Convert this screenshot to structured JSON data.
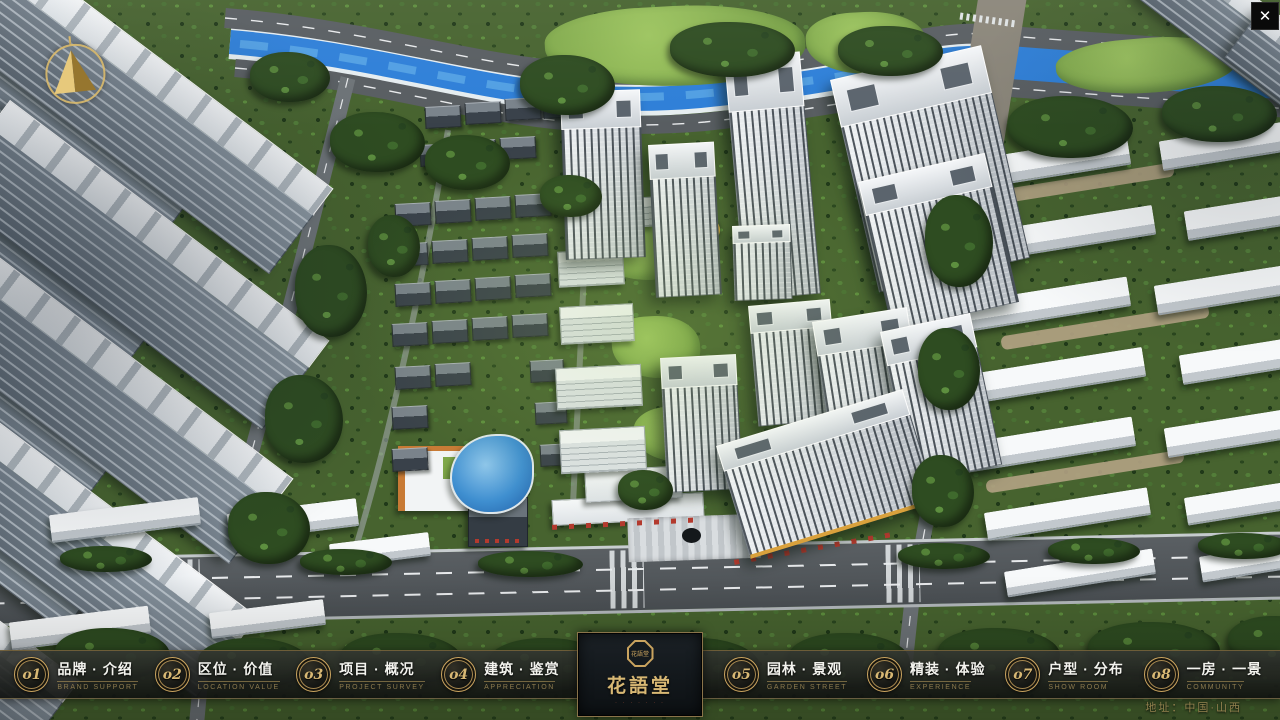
{
  "window": {
    "close_glyph": "✕"
  },
  "nav": {
    "items": [
      {
        "num": "o1",
        "zh": "品牌 · 介绍",
        "en": "BRAND SUPPORT"
      },
      {
        "num": "o2",
        "zh": "区位 · 价值",
        "en": "LOCATION VALUE"
      },
      {
        "num": "o3",
        "zh": "项目 · 概况",
        "en": "PROJECT SURVEY"
      },
      {
        "num": "o4",
        "zh": "建筑 · 鉴赏",
        "en": "APPRECIATION"
      },
      {
        "num": "o5",
        "zh": "园林 · 景观",
        "en": "GARDEN STREET"
      },
      {
        "num": "o6",
        "zh": "精装 · 体验",
        "en": "EXPERIENCE"
      },
      {
        "num": "o7",
        "zh": "户型 · 分布",
        "en": "SHOW ROOM"
      },
      {
        "num": "o8",
        "zh": "一房 · 一景",
        "en": "COMMUNITY"
      }
    ]
  },
  "logo": {
    "title": "花語堂",
    "seal_text": "花語堂",
    "subtitle": "· · · · · · ·"
  },
  "footer": {
    "address": "地址：中国·山西"
  },
  "colors": {
    "gold": "#c9a15b",
    "river_blue": "#2e7fd8",
    "bar_bg": "#141614",
    "tree_green": "#2e4c21"
  }
}
